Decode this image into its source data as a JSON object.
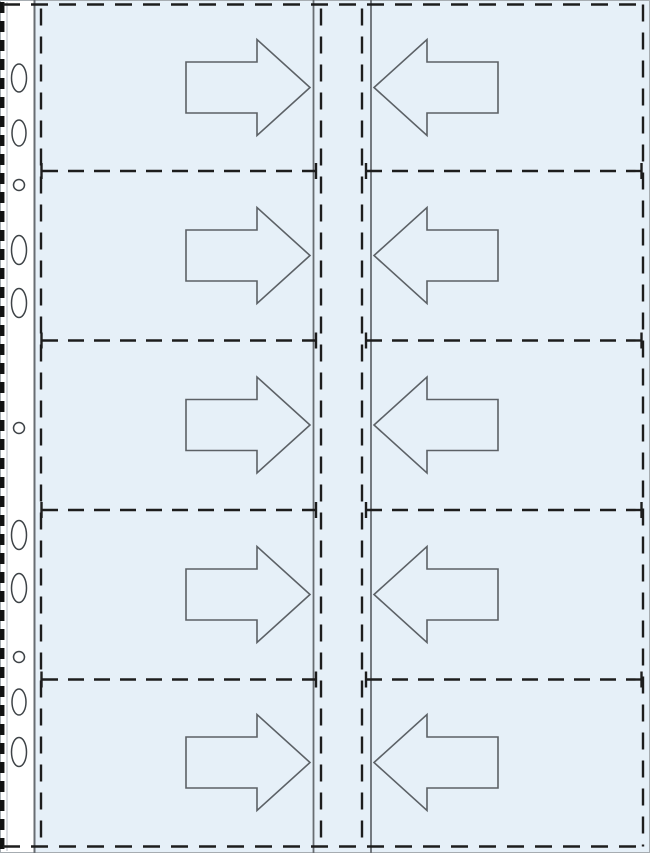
{
  "diagram": {
    "title": "pocket-page-insertion-diagram",
    "description": "Ring binder pocket page with left punched filing strip, 5 rows x 2 columns of pockets, arrows showing card insertion direction toward the centre spine",
    "canvas": {
      "width": 650,
      "height": 853
    },
    "colors": {
      "page_background": "#ffffff",
      "film_fill": "#e6f0f8",
      "filing_strip_fill": "#ffffff",
      "weld_dash": "#1d1d1d",
      "edge_dash": "#121212",
      "solid_line": "#686d72",
      "outer_edge": "#a6acb1",
      "strip_inner_line": "#b5bac0",
      "arrow_stroke": "#5c6166",
      "hole_stroke": "#3e4347",
      "hole_fill": "#ffffff"
    },
    "film": {
      "x": 34,
      "y": 0,
      "width": 616,
      "height": 853
    },
    "filing_strip": {
      "width": 34,
      "edge_dash_x": 2.2,
      "edge_dash_width": 4.5,
      "edge_dash_pattern": "11 8",
      "inner_line_x": 7,
      "strip_film_boundary_x": 34.5,
      "hole_center_x": 19,
      "holes": [
        {
          "y": 78,
          "shape": "oblong",
          "rx": 7.5,
          "ry": 14
        },
        {
          "y": 133,
          "shape": "oblong",
          "rx": 7,
          "ry": 13
        },
        {
          "y": 185,
          "shape": "round",
          "rx": 5.5,
          "ry": 5.5
        },
        {
          "y": 250,
          "shape": "oblong",
          "rx": 7.5,
          "ry": 14.5
        },
        {
          "y": 303,
          "shape": "oblong",
          "rx": 7.5,
          "ry": 14.5
        },
        {
          "y": 428,
          "shape": "round",
          "rx": 5.5,
          "ry": 5.5
        },
        {
          "y": 535,
          "shape": "oblong",
          "rx": 7.5,
          "ry": 14.5
        },
        {
          "y": 588,
          "shape": "oblong",
          "rx": 7.5,
          "ry": 14.5
        },
        {
          "y": 657,
          "shape": "round",
          "rx": 5.5,
          "ry": 5.5
        },
        {
          "y": 702,
          "shape": "oblong",
          "rx": 7,
          "ry": 13
        },
        {
          "y": 752,
          "shape": "oblong",
          "rx": 7.5,
          "ry": 14.5
        }
      ]
    },
    "border": {
      "top_y": 4.5,
      "bottom_y": 846.5,
      "right_dash_x": 643,
      "left_pocket_dash_x": 41,
      "dash_start_x": 3,
      "dash_end_x": 647,
      "dash_pattern": "17 11",
      "dash_width": 2.4
    },
    "spine": {
      "solid_x": [
        313.5,
        371
      ],
      "dashed_x": [
        321,
        362
      ],
      "solid_width": 1.8
    },
    "grid": {
      "rows": 5,
      "columns": 2,
      "row_centers": [
        87.5,
        255.5,
        425,
        594.5,
        762.5
      ],
      "separator_ys": [
        171,
        340.5,
        510,
        679.5
      ],
      "separator_left_span": [
        42,
        316
      ],
      "separator_right_span": [
        366,
        642
      ],
      "separator_cap_xs": [
        41.5,
        316,
        366,
        641.5
      ],
      "separator_cap_half_height": 8,
      "separator_dash_pattern": "16 10"
    },
    "arrows": {
      "stroke_width": 1.6,
      "shaft_half_height": 25.5,
      "head_half_height": 48,
      "left_column": {
        "direction": "right",
        "x_tail": 186,
        "x_head_base": 257,
        "x_tip": 310
      },
      "right_column": {
        "direction": "left",
        "x_tail": 498,
        "x_head_base": 427,
        "x_tip": 374
      }
    }
  }
}
